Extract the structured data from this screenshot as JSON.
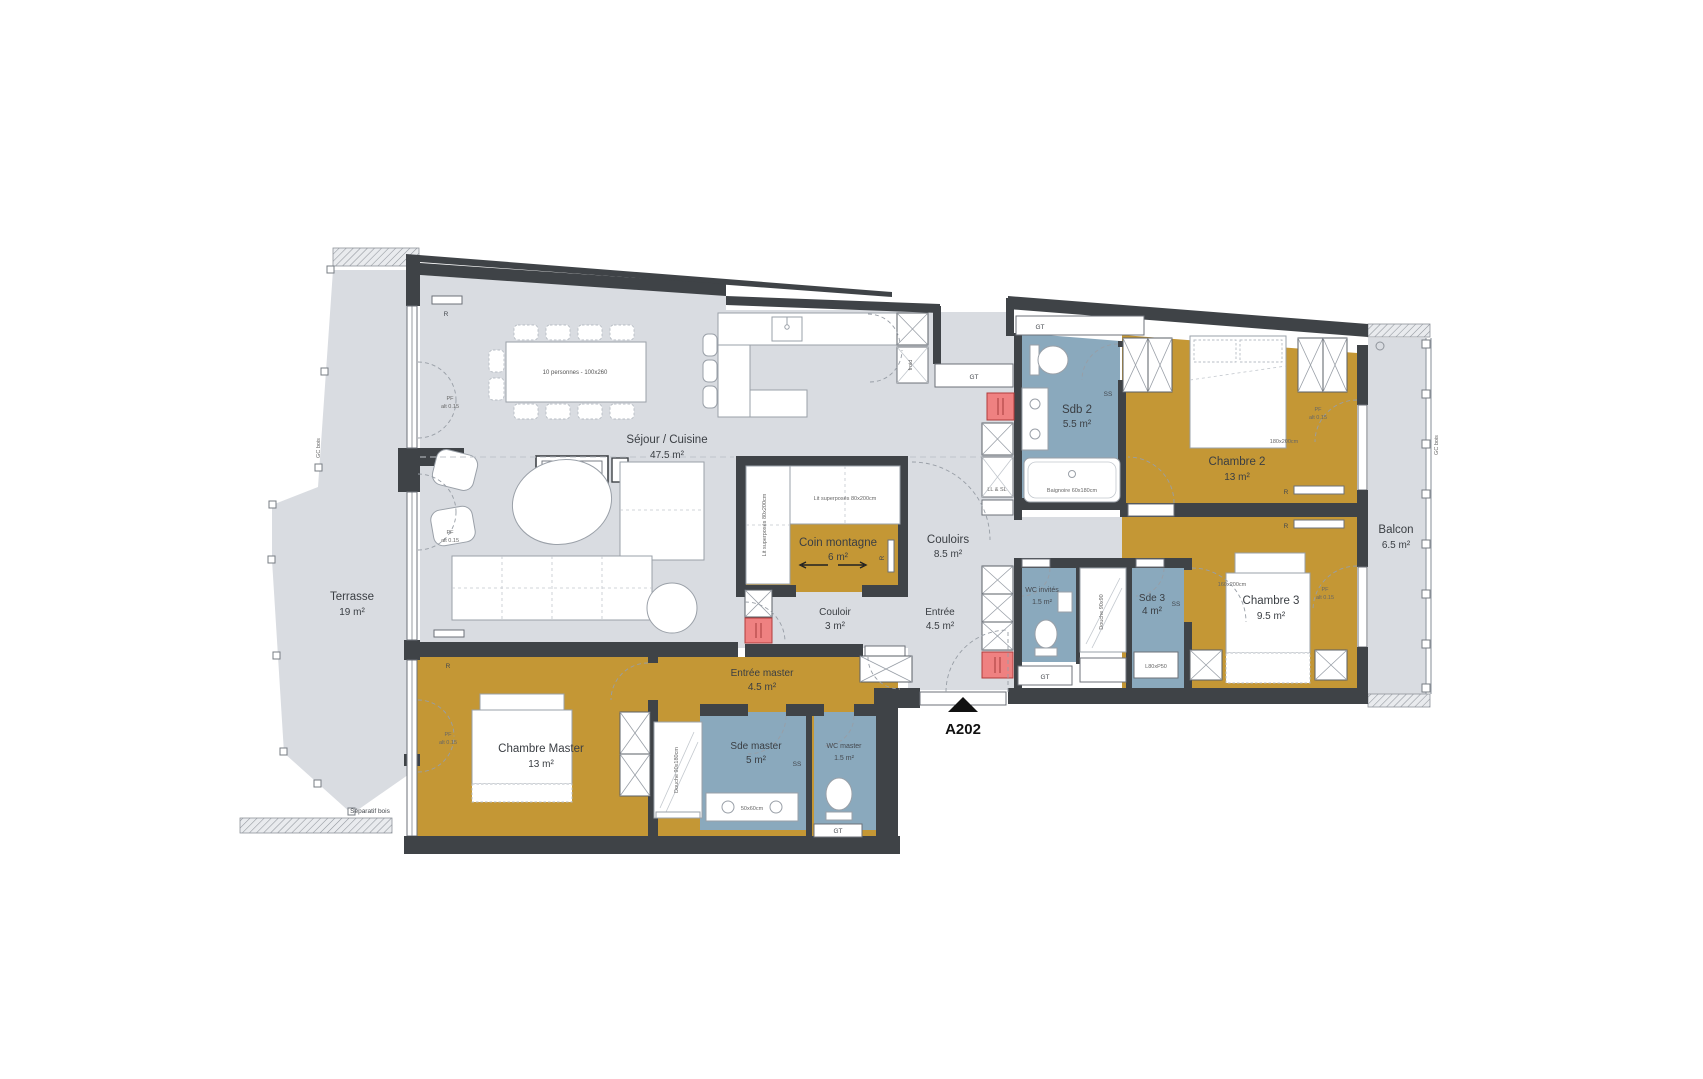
{
  "unit": {
    "label": "A202"
  },
  "rooms": {
    "terrasse": {
      "name": "Terrasse",
      "area": "19 m²"
    },
    "sejour": {
      "name": "Séjour / Cuisine",
      "area": "47.5 m²"
    },
    "coin_montagne": {
      "name": "Coin montagne",
      "area": "6 m²"
    },
    "couloir": {
      "name": "Couloir",
      "area": "3 m²"
    },
    "couloirs": {
      "name": "Couloirs",
      "area": "8.5 m²"
    },
    "entree": {
      "name": "Entrée",
      "area": "4.5 m²"
    },
    "entree_master": {
      "name": "Entrée master",
      "area": "4.5 m²"
    },
    "chambre_master": {
      "name": "Chambre Master",
      "area": "13 m²"
    },
    "sde_master": {
      "name": "Sde master",
      "area": "5 m²"
    },
    "wc_master": {
      "name": "WC master",
      "area": "1.5 m²"
    },
    "sdb2": {
      "name": "Sdb 2",
      "area": "5.5 m²"
    },
    "chambre2": {
      "name": "Chambre 2",
      "area": "13 m²"
    },
    "chambre3": {
      "name": "Chambre 3",
      "area": "9.5 m²"
    },
    "sde3": {
      "name": "Sde 3",
      "area": "4 m²"
    },
    "wc_invites": {
      "name": "WC invités",
      "area": "1.5 m²"
    },
    "balcon": {
      "name": "Balcon",
      "area": "6.5 m²"
    }
  },
  "furniture": {
    "dining_table": "10 personnes - 100x260",
    "cheminee": "Cheminée vapeur",
    "lit_superposes": "Lit superposés 80x200cm",
    "bed2_size": "180x200cm",
    "bed3_size": "160x200cm",
    "baignoire": "Baignoire 60x180cm",
    "douche_sde3": "Douche 90x90",
    "douche_master": "Douche 90x180cm",
    "vasque_master": "50x60cm",
    "meuble_sde3": "L80xP50",
    "lave_linge": "LL & SL",
    "froid": "froid"
  },
  "tags": {
    "gt": "GT",
    "ss": "SS",
    "r": "R",
    "pf": "PF",
    "pf_alt": "alt 0.15",
    "separatif": "Séparatif bois",
    "gc": "GC bois"
  },
  "colors": {
    "floor": "#d9dce1",
    "bedroom": "#c49735",
    "bathroom": "#8aa9bd",
    "wall": "#3f4347",
    "shaft": "#ef8181"
  }
}
